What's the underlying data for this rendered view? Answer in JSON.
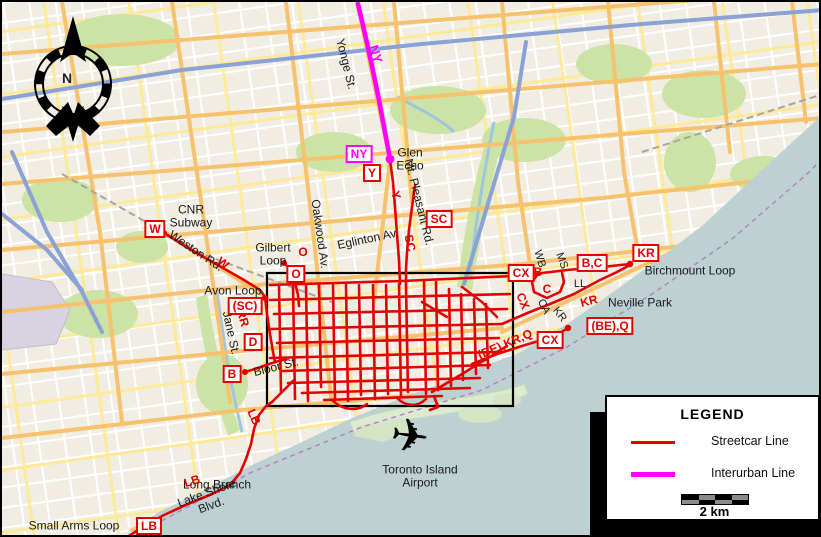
{
  "map_meta": {
    "region": "Toronto transit map",
    "colors": {
      "streetcar": "#e60000",
      "interurban": "#ff00ff",
      "water": "#bdd1d3",
      "land": "#f1ede3",
      "major_road": "#f6c26e",
      "park": "#cbe3a4",
      "motorway": "#8ba2d6"
    }
  },
  "legend": {
    "title": "LEGEND",
    "items": [
      {
        "label": "Streetcar Line",
        "color": "#e60000"
      },
      {
        "label": "Interurban Line",
        "color": "#ff00ff"
      }
    ],
    "scale_label": "2 km"
  },
  "compass": {
    "north_label": "N"
  },
  "markers": {
    "w": "W",
    "ny": "NY",
    "y": "Y",
    "sc": "SC",
    "o": "O",
    "sc_paren": "(SC)",
    "d": "D",
    "b": "B",
    "cx_north": "CX",
    "bc": "B,C",
    "kr": "KR",
    "cx_south": "CX",
    "beq": "(BE),Q",
    "lb": "LB"
  },
  "inline_routes": {
    "ny": "NY",
    "y": "Y",
    "sc": "SC",
    "w": "W",
    "o": "O",
    "rr": "RR",
    "b": "B",
    "c": "C",
    "cx": "CX",
    "kr": "KR",
    "bekrq": "(BE),KR,Q",
    "lb_shore": "LB",
    "lb_humber": "LB"
  },
  "streets": {
    "yonge": "Yonge St.",
    "mt_pleasant": "Mt. Pleasant Rd.",
    "oakwood": "Oakwood Av.",
    "eglinton": "Eglinton Av.",
    "weston": "Weston Rd.",
    "jane": "Jane St.",
    "bloor": "Bloor St.",
    "lake_shore": "Lake Shore Blvd.",
    "wb": "WB",
    "ms": "MS",
    "ll": "LL",
    "ca": "CA",
    "kr": "KR"
  },
  "places": {
    "glen_echo": "Glen Echo",
    "cnr_subway": "CNR Subway",
    "gilbert_loop": "Gilbert Loop",
    "avon_loop": "Avon Loop",
    "birchmount_loop": "Birchmount Loop",
    "neville_park": "Neville Park",
    "long_branch": "Long Branch",
    "small_arms_loop": "Small Arms Loop",
    "island_airport": "Toronto Island Airport"
  }
}
